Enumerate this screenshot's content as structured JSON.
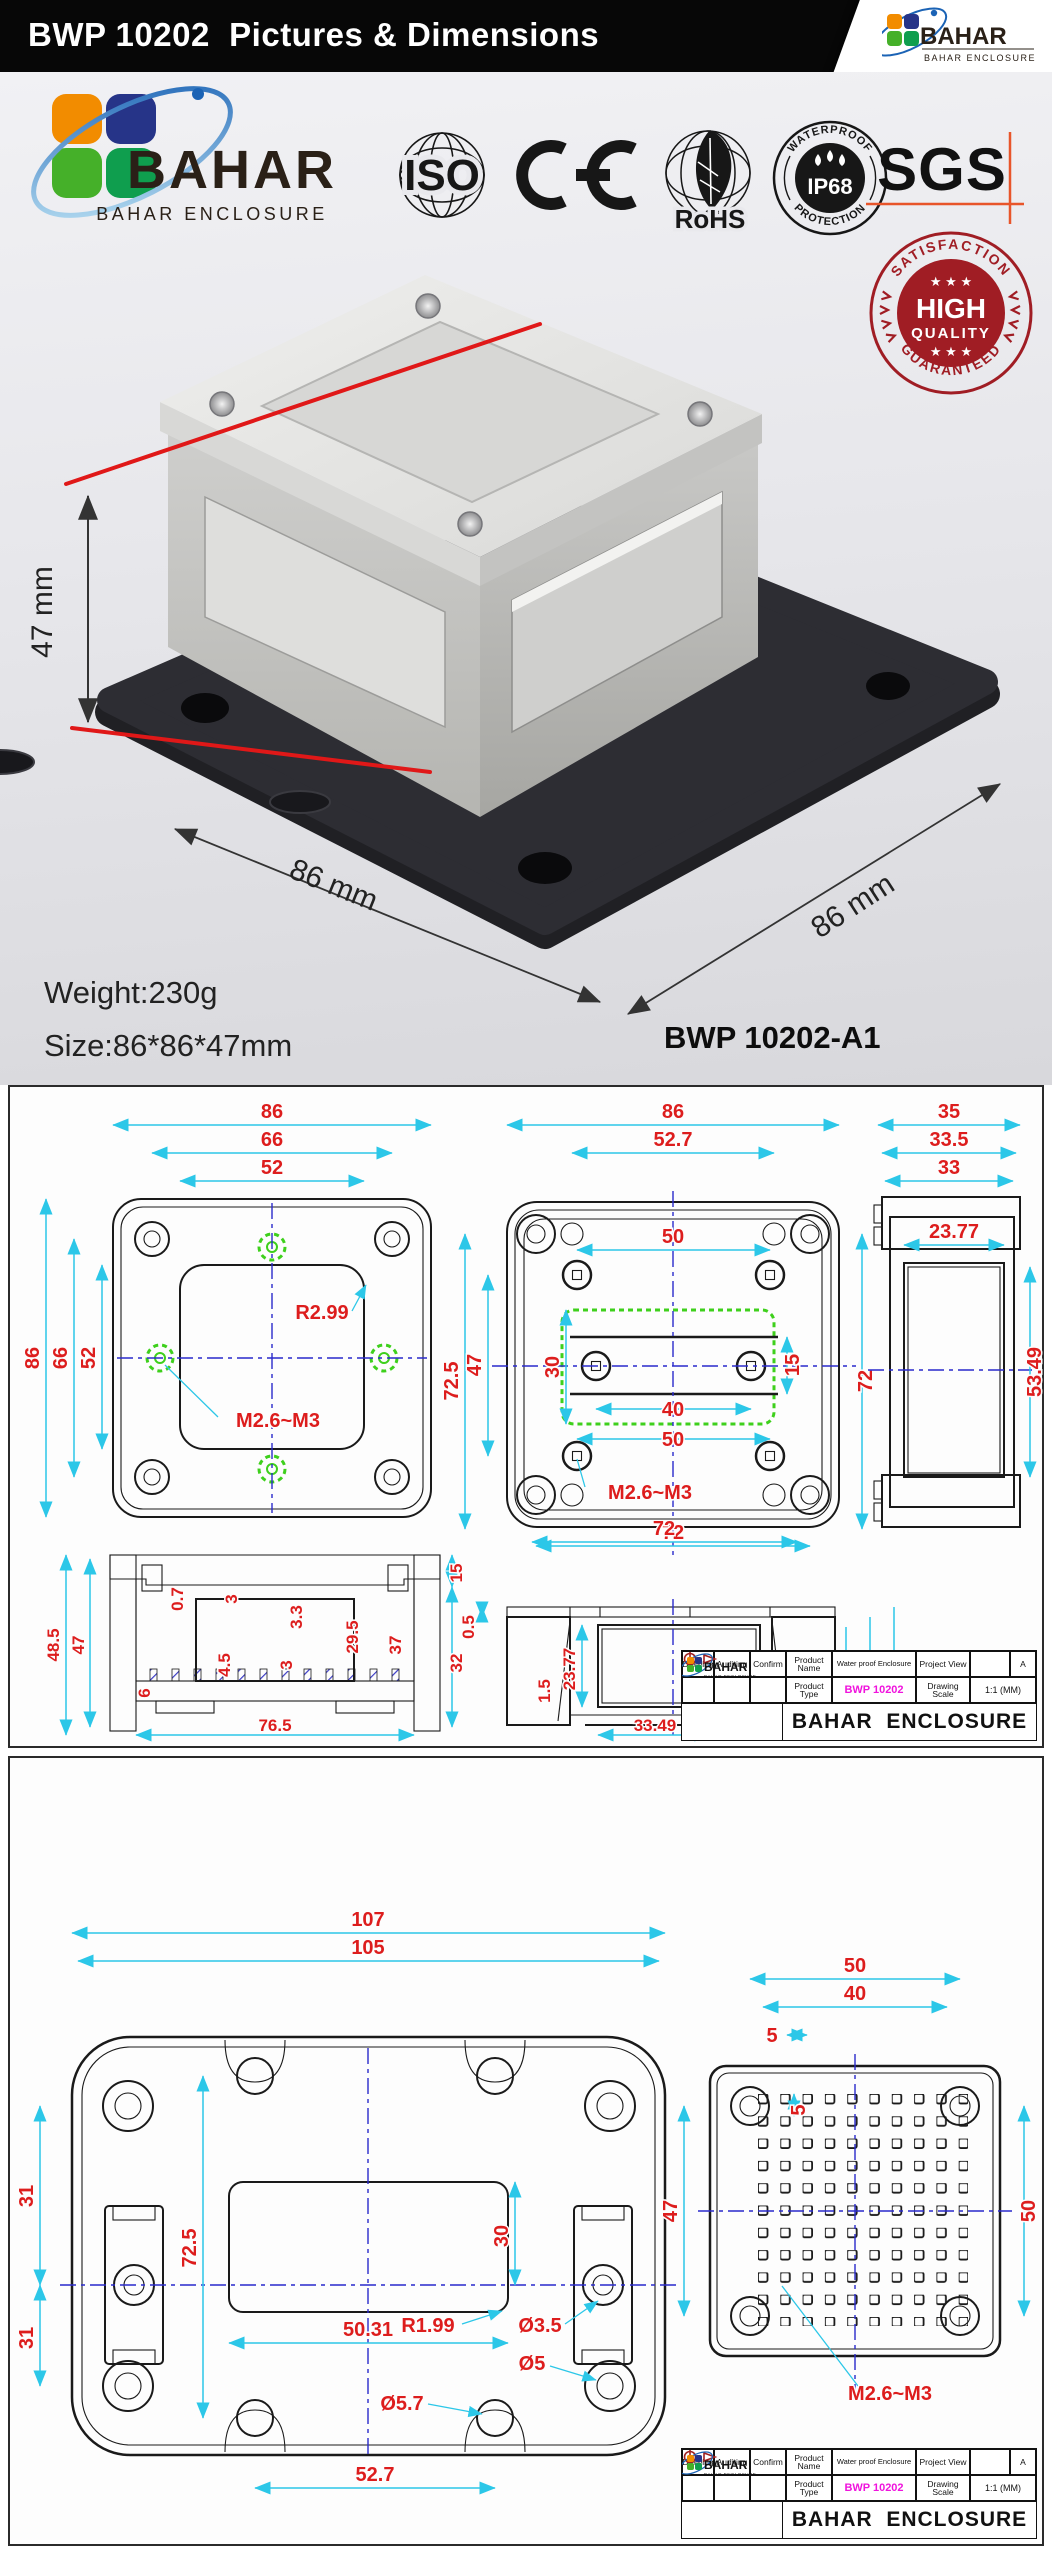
{
  "header": {
    "title": "BWP 10202  Pictures & Dimensions"
  },
  "brand": {
    "name": "BAHAR",
    "sub": "BAHAR ENCLOSURE"
  },
  "certs": {
    "iso": "ISO",
    "ce": "CE",
    "rohs": "RoHS",
    "ip68_top": "WATERPROOF",
    "ip68": "IP68",
    "ip68_bottom": "PROTECTION",
    "sgs": "SGS"
  },
  "badge": {
    "top": "SATISFACTION",
    "line1": "HIGH",
    "line2": "QUALITY",
    "bottom": "GUARANTEED",
    "stars": "★ ★ ★"
  },
  "photo": {
    "dim_h": "47 mm",
    "dim_w": "86 mm",
    "dim_d": "86 mm",
    "weight": "Weight:230g",
    "size": "Size:86*86*47mm",
    "model": "BWP 10202-A1"
  },
  "d1": {
    "lid": {
      "t86": "86",
      "t66": "66",
      "t52": "52",
      "l86": "86",
      "l66": "66",
      "l52": "52",
      "r": "R2.99",
      "screw": "M2.6~M3"
    },
    "body": {
      "t86": "86",
      "t527": "52.7",
      "i50t": "50",
      "i30": "30",
      "i15": "15",
      "i40": "40",
      "i50b": "50",
      "l725": "72.5",
      "l47": "47",
      "r72": "72",
      "b72": "72",
      "screw": "M2.6~M3"
    },
    "side": {
      "t35": "35",
      "t335": "33.5",
      "t33": "33",
      "i2377": "23.77",
      "r5349": "53.49"
    },
    "sec": {
      "l485": "48.5",
      "l47": "47",
      "i07": "0.7",
      "i3a": "3",
      "i33": "3.3",
      "i45": "4.5",
      "i3b": "3",
      "i6": "6",
      "r295": "29.5",
      "r37": "37",
      "r15": "15",
      "r32": "32",
      "b765": "76.5"
    },
    "elev": {
      "t72": "72",
      "l05": "0.5",
      "l15": "1.5",
      "l2377": "23.77",
      "r33": "33",
      "r335": "33.5",
      "r35": "35",
      "b3349": "33.49"
    }
  },
  "d2": {
    "base": {
      "t107": "107",
      "t105": "105",
      "l31a": "31",
      "l725": "72.5",
      "l31b": "31",
      "i30": "30",
      "r199": "R1.99",
      "d35": "Ø3.5",
      "i5031": "50.31",
      "d5": "Ø5",
      "d57": "Ø5.7",
      "b527": "52.7"
    },
    "plate": {
      "t50": "50",
      "t40": "40",
      "t5": "5",
      "i5": "5",
      "l47": "47",
      "r50": "50",
      "screw": "M2.6~M3"
    }
  },
  "titleblock": {
    "c1": "Drawing",
    "c2": "Auditing",
    "c3": "Confirm",
    "c4": "Product Name",
    "v4": "Water proof Enclosure",
    "c5": "Project View",
    "sheet": "A",
    "c6": "Product Type",
    "v6": "BWP 10202",
    "c7": "Drawing Scale",
    "v7": "1:1 (MM)",
    "company": "BAHAR  ENCLOSURE"
  },
  "colors": {
    "accent_red": "#dd1d1d",
    "dim_cyan": "#2cc7e8",
    "center_blue": "#2a2acb",
    "hole_green": "#3ed01c",
    "model_magenta": "#f013dd",
    "badge_red": "#a01d24",
    "sgs_orange": "#e8552a"
  }
}
